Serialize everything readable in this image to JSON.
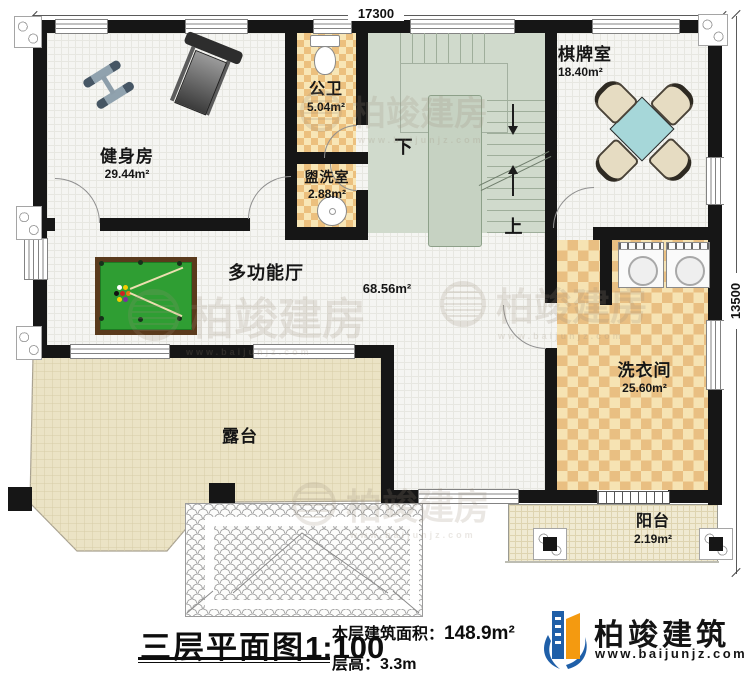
{
  "dimensions": {
    "top": "17300",
    "right": "13500"
  },
  "rooms": {
    "gym": {
      "name": "健身房",
      "area": "29.44m²"
    },
    "public_bath": {
      "name": "公卫",
      "area": "5.04m²"
    },
    "washroom": {
      "name": "盥洗室",
      "area": "2.88m²"
    },
    "chess": {
      "name": "棋牌室",
      "area": "18.40m²"
    },
    "hall": {
      "name": "多功能厅",
      "area": "68.56m²"
    },
    "laundry": {
      "name": "洗衣间",
      "area": "25.60m²"
    },
    "terrace": {
      "name": "露台"
    },
    "balcony": {
      "name": "阳台",
      "area": "2.19m²"
    }
  },
  "stairs": {
    "up": "上",
    "down": "下"
  },
  "title_block": {
    "title": "三层平面图",
    "scale": "1:100",
    "area_label": "本层建筑面积：",
    "area_value": "148.9m²",
    "height_label": "层高：",
    "height_value": "3.3m"
  },
  "branding": {
    "company": "柏竣建筑",
    "website": "www.baijunjz.com"
  },
  "watermark": {
    "text": "柏竣建房",
    "subtext": "www.baijunjz.com"
  },
  "colors": {
    "wall": "#161616",
    "stair_area": "#d0dacc",
    "bath_checker": "#ecc07e",
    "laundry_checker": "#e9bf82",
    "terrace": "#ebe3c5",
    "balcony": "#f0ead2",
    "billiard_green": "#2f9e33",
    "billiard_frame": "#5a3a1c",
    "game_table_teal": "#a6d7d9",
    "logo_blue": "#1f5fa8",
    "logo_orange": "#f49a10"
  }
}
